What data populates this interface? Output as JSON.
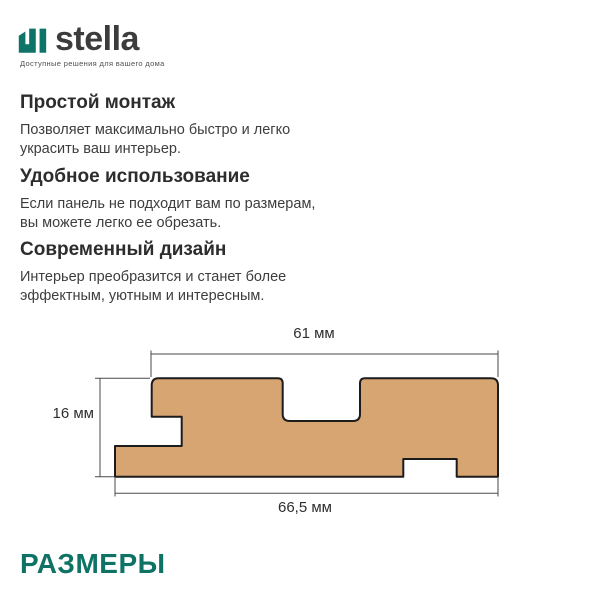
{
  "brand": {
    "name": "stella",
    "tagline": "Доступные решения для вашего дома",
    "logo_color": "#0E7467"
  },
  "features": [
    {
      "title": "Простой монтаж",
      "lines": [
        "Позволяет максимально быстро и легко",
        "украсить ваш интерьер."
      ]
    },
    {
      "title": "Удобное использование",
      "lines": [
        "Если панель не подходит вам по размерам,",
        "вы можете легко ее обрезать."
      ]
    },
    {
      "title": "Современный дизайн",
      "lines": [
        "Интерьер преобразится и станет более",
        "эффектным, уютным и интересным."
      ]
    }
  ],
  "diagram": {
    "type": "panel-cross-section",
    "dimensions": {
      "top_width": "61 мм",
      "height": "16 мм",
      "bottom_width": "66,5 мм"
    },
    "panel_fill": "#D7A571",
    "panel_outline": "#1C1C1C",
    "line_color": "#4A4A4A"
  },
  "footer": {
    "section_label": "РАЗМЕРЫ",
    "accent_color": "#0E7264"
  }
}
